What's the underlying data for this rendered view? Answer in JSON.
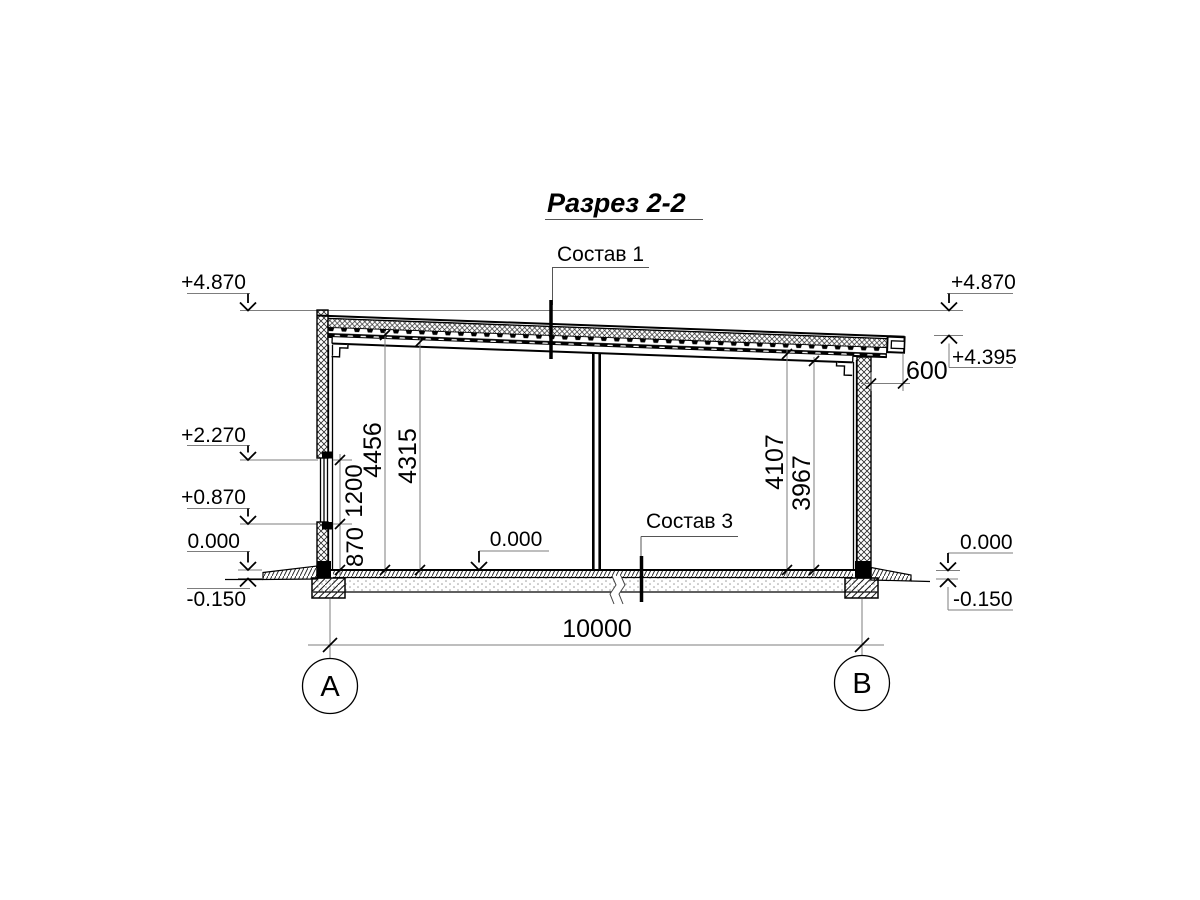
{
  "title": "Разрез 2-2",
  "callouts": {
    "layer1": "Состав 1",
    "layer3": "Состав 3"
  },
  "elevations": {
    "left_top": "+4.870",
    "left_mid": "+2.270",
    "left_low": "+0.870",
    "left_zero": "0.000",
    "left_below": "-0.150",
    "right_top": "+4.870",
    "right_eave": "+4.395",
    "right_zero": "0.000",
    "right_below": "-0.150",
    "floor_zero": "0.000"
  },
  "dimensions": {
    "overhang": "600",
    "sill_height": "870",
    "window_height": "1200",
    "left_clear_1": "4456",
    "left_clear_2": "4315",
    "right_clear_1": "4107",
    "right_clear_2": "3967",
    "span": "10000"
  },
  "axes": {
    "left": "А",
    "right": "В"
  },
  "colors": {
    "line": "#000000",
    "dim_line": "#7d7d7d",
    "background": "#ffffff"
  }
}
